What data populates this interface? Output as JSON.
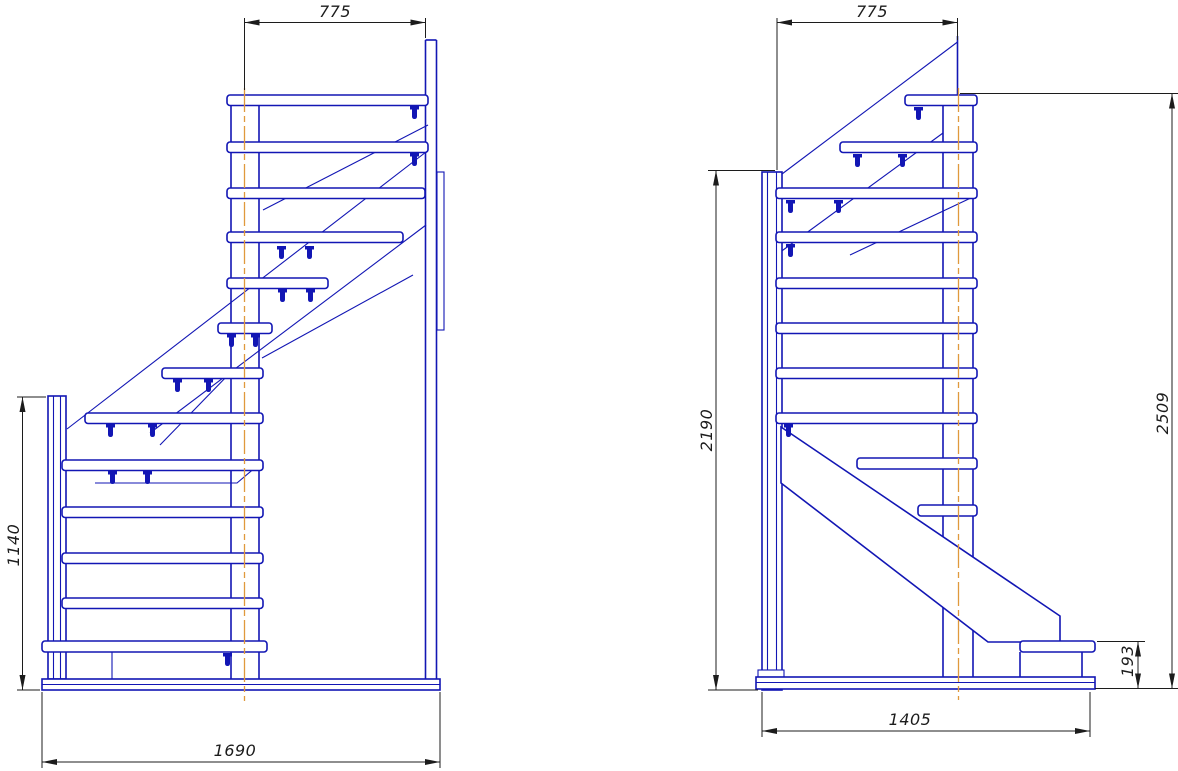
{
  "drawing": {
    "background": "#ffffff",
    "line_color": "#1216b4",
    "centerline_color": "#e0993c",
    "dimension_color": "#1c1c1c",
    "left_view": {
      "dim_top_width": "775",
      "dim_left_height": "1140",
      "dim_bottom_width": "1690"
    },
    "right_view": {
      "dim_top_width": "775",
      "dim_left_height": "2190",
      "dim_right_height": "2509",
      "dim_landing_height": "193",
      "dim_bottom_width": "1405"
    }
  }
}
